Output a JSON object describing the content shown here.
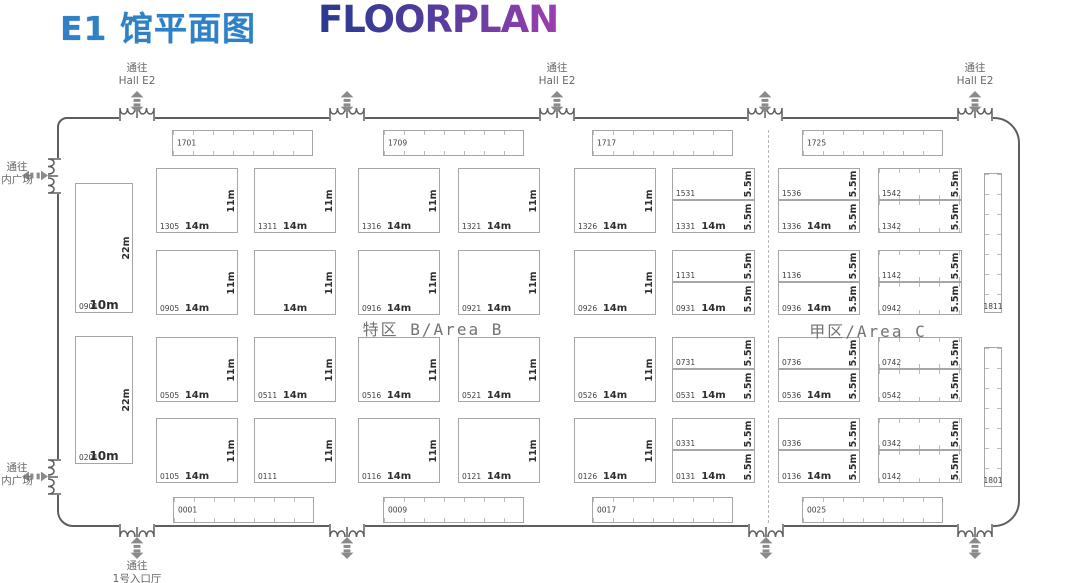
{
  "title": {
    "cn": "E1 馆平面图",
    "en": "FLOORPLAN"
  },
  "areas": {
    "b": "特区 B/Area B",
    "c": "甲区/Area C"
  },
  "colors": {
    "title_blue": "#2f80c4",
    "gradient_start": "#283a8f",
    "gradient_end": "#9b3fb0",
    "wall": "#5e5e5e",
    "booth_border": "#a6a6a6",
    "arrow": "#8a8a8a",
    "label": "#686868"
  },
  "passages": [
    {
      "lines": "通往\nHall E2",
      "x": 137,
      "y": 62,
      "w": 84
    },
    {
      "lines": "通往\nHall E2",
      "x": 557,
      "y": 62,
      "w": 84
    },
    {
      "lines": "通往\nHall E2",
      "x": 975,
      "y": 62,
      "w": 84
    },
    {
      "lines": "通往\n内广场",
      "x": 17,
      "y": 161,
      "w": 44
    },
    {
      "lines": "通往\n内广场",
      "x": 17,
      "y": 462,
      "w": 44
    },
    {
      "lines": "通往\n1号入口厅",
      "x": 137,
      "y": 560,
      "w": 100
    }
  ],
  "doors": [
    {
      "s": "t",
      "x": 137
    },
    {
      "s": "t",
      "x": 347
    },
    {
      "s": "t",
      "x": 557
    },
    {
      "s": "t",
      "x": 765
    },
    {
      "s": "t",
      "x": 975
    },
    {
      "s": "b",
      "x": 137
    },
    {
      "s": "b",
      "x": 347
    },
    {
      "s": "b",
      "x": 766
    },
    {
      "s": "b",
      "x": 975
    },
    {
      "s": "l",
      "y": 176
    },
    {
      "s": "l",
      "y": 477
    }
  ],
  "booths": [
    {
      "n": "1701",
      "x": 172,
      "y": 130,
      "w": 141,
      "h": 26,
      "t": "h",
      "np": "lc"
    },
    {
      "n": "1709",
      "x": 383,
      "y": 130,
      "w": 141,
      "h": 26,
      "t": "h",
      "np": "lc"
    },
    {
      "n": "1717",
      "x": 592,
      "y": 130,
      "w": 141,
      "h": 26,
      "t": "h",
      "np": "lc"
    },
    {
      "n": "1725",
      "x": 802,
      "y": 130,
      "w": 141,
      "h": 26,
      "t": "h",
      "np": "lc"
    },
    {
      "n": "0001",
      "x": 173,
      "y": 497,
      "w": 141,
      "h": 26,
      "t": "h",
      "np": "lc"
    },
    {
      "n": "0009",
      "x": 383,
      "y": 497,
      "w": 141,
      "h": 26,
      "t": "h",
      "np": "lc"
    },
    {
      "n": "0017",
      "x": 592,
      "y": 497,
      "w": 141,
      "h": 26,
      "t": "h",
      "np": "lc"
    },
    {
      "n": "0025",
      "x": 802,
      "y": 497,
      "w": 141,
      "h": 26,
      "t": "h",
      "np": "lc"
    },
    {
      "n": "0901",
      "x": 75,
      "y": 183,
      "w": 58,
      "h": 130,
      "dw": "10m",
      "dh": "22m",
      "big": 1
    },
    {
      "n": "0201",
      "x": 75,
      "y": 336,
      "w": 58,
      "h": 128,
      "dw": "10m",
      "dh": "22m",
      "big": 1
    },
    {
      "n": "1305",
      "x": 156,
      "y": 168,
      "w": 82,
      "h": 65,
      "dw": "14m",
      "dh": "11m"
    },
    {
      "n": "1311",
      "x": 254,
      "y": 168,
      "w": 82,
      "h": 65,
      "dw": "14m",
      "dh": "11m"
    },
    {
      "n": "1316",
      "x": 358,
      "y": 168,
      "w": 82,
      "h": 65,
      "dw": "14m",
      "dh": "11m"
    },
    {
      "n": "1321",
      "x": 458,
      "y": 168,
      "w": 82,
      "h": 65,
      "dw": "14m",
      "dh": "11m"
    },
    {
      "n": "1326",
      "x": 574,
      "y": 168,
      "w": 82,
      "h": 65,
      "dw": "14m",
      "dh": "11m"
    },
    {
      "n": "0905",
      "x": 156,
      "y": 250,
      "w": 82,
      "h": 65,
      "dw": "14m",
      "dh": "11m"
    },
    {
      "n": "",
      "x": 254,
      "y": 250,
      "w": 82,
      "h": 65,
      "dw": "14m",
      "dh": "11m"
    },
    {
      "n": "0916",
      "x": 358,
      "y": 250,
      "w": 82,
      "h": 65,
      "dw": "14m",
      "dh": "11m"
    },
    {
      "n": "0921",
      "x": 458,
      "y": 250,
      "w": 82,
      "h": 65,
      "dw": "14m",
      "dh": "11m"
    },
    {
      "n": "0926",
      "x": 574,
      "y": 250,
      "w": 82,
      "h": 65,
      "dw": "14m",
      "dh": "11m"
    },
    {
      "n": "0505",
      "x": 156,
      "y": 337,
      "w": 82,
      "h": 65,
      "dw": "14m",
      "dh": "11m"
    },
    {
      "n": "0511",
      "x": 254,
      "y": 337,
      "w": 82,
      "h": 65,
      "dw": "14m",
      "dh": "11m"
    },
    {
      "n": "0516",
      "x": 358,
      "y": 337,
      "w": 82,
      "h": 65,
      "dw": "14m",
      "dh": "11m"
    },
    {
      "n": "0521",
      "x": 458,
      "y": 337,
      "w": 82,
      "h": 65,
      "dw": "14m",
      "dh": "11m"
    },
    {
      "n": "0526",
      "x": 574,
      "y": 337,
      "w": 82,
      "h": 65,
      "dw": "14m",
      "dh": "11m"
    },
    {
      "n": "0105",
      "x": 156,
      "y": 418,
      "w": 82,
      "h": 65,
      "dw": "14m",
      "dh": "11m"
    },
    {
      "n": "0111",
      "x": 254,
      "y": 418,
      "w": 82,
      "h": 65,
      "dh": "11m"
    },
    {
      "n": "0116",
      "x": 358,
      "y": 418,
      "w": 82,
      "h": 65,
      "dw": "14m",
      "dh": "11m"
    },
    {
      "n": "0121",
      "x": 458,
      "y": 418,
      "w": 82,
      "h": 65,
      "dw": "14m",
      "dh": "11m"
    },
    {
      "n": "0126",
      "x": 574,
      "y": 418,
      "w": 82,
      "h": 65,
      "dw": "14m",
      "dh": "11m"
    },
    {
      "n": "1531",
      "x": 672,
      "y": 168,
      "w": 83,
      "h": 32,
      "dh": "5.5m"
    },
    {
      "n": "1331",
      "x": 672,
      "y": 200,
      "w": 83,
      "h": 33,
      "dw": "14m",
      "dh": "5.5m"
    },
    {
      "n": "1131",
      "x": 672,
      "y": 250,
      "w": 83,
      "h": 32,
      "dh": "5.5m"
    },
    {
      "n": "0931",
      "x": 672,
      "y": 282,
      "w": 83,
      "h": 33,
      "dw": "14m",
      "dh": "5.5m"
    },
    {
      "n": "0731",
      "x": 672,
      "y": 337,
      "w": 83,
      "h": 32,
      "dh": "5.5m"
    },
    {
      "n": "0531",
      "x": 672,
      "y": 369,
      "w": 83,
      "h": 33,
      "dw": "14m",
      "dh": "5.5m"
    },
    {
      "n": "0331",
      "x": 672,
      "y": 418,
      "w": 83,
      "h": 32,
      "dh": "5.5m"
    },
    {
      "n": "0131",
      "x": 672,
      "y": 450,
      "w": 83,
      "h": 33,
      "dw": "14m",
      "dh": "5.5m"
    },
    {
      "n": "1536",
      "x": 778,
      "y": 168,
      "w": 82,
      "h": 32,
      "dh": "5.5m"
    },
    {
      "n": "1336",
      "x": 778,
      "y": 200,
      "w": 82,
      "h": 33,
      "dw": "14m",
      "dh": "5.5m"
    },
    {
      "n": "1136",
      "x": 778,
      "y": 250,
      "w": 82,
      "h": 32,
      "dh": "5.5m"
    },
    {
      "n": "0936",
      "x": 778,
      "y": 282,
      "w": 82,
      "h": 33,
      "dw": "14m",
      "dh": "5.5m"
    },
    {
      "n": "0736",
      "x": 778,
      "y": 337,
      "w": 82,
      "h": 32,
      "dh": "5.5m"
    },
    {
      "n": "0536",
      "x": 778,
      "y": 369,
      "w": 82,
      "h": 33,
      "dw": "14m",
      "dh": "5.5m"
    },
    {
      "n": "0336",
      "x": 778,
      "y": 418,
      "w": 82,
      "h": 32,
      "dh": "5.5m"
    },
    {
      "n": "0136",
      "x": 778,
      "y": 450,
      "w": 82,
      "h": 33,
      "dw": "14m",
      "dh": "5.5m"
    },
    {
      "n": "1542",
      "x": 878,
      "y": 168,
      "w": 84,
      "h": 32,
      "t": "h",
      "dh": "5.5m"
    },
    {
      "n": "1342",
      "x": 878,
      "y": 200,
      "w": 84,
      "h": 33,
      "t": "h",
      "dh": "5.5m"
    },
    {
      "n": "1142",
      "x": 878,
      "y": 250,
      "w": 84,
      "h": 32,
      "t": "h",
      "dh": "5.5m"
    },
    {
      "n": "0942",
      "x": 878,
      "y": 282,
      "w": 84,
      "h": 33,
      "t": "h",
      "dh": "5.5m"
    },
    {
      "n": "0742",
      "x": 878,
      "y": 337,
      "w": 84,
      "h": 32,
      "t": "h",
      "dh": "5.5m"
    },
    {
      "n": "0542",
      "x": 878,
      "y": 369,
      "w": 84,
      "h": 33,
      "t": "h",
      "dh": "5.5m"
    },
    {
      "n": "0342",
      "x": 878,
      "y": 418,
      "w": 84,
      "h": 32,
      "t": "h",
      "dh": "5.5m"
    },
    {
      "n": "0142",
      "x": 878,
      "y": 450,
      "w": 84,
      "h": 33,
      "t": "h",
      "dh": "5.5m"
    },
    {
      "n": "1811",
      "x": 984,
      "y": 173,
      "w": 18,
      "h": 140,
      "t": "v",
      "np": "bc"
    },
    {
      "n": "1801",
      "x": 984,
      "y": 347,
      "w": 18,
      "h": 140,
      "t": "v",
      "np": "bc"
    }
  ]
}
